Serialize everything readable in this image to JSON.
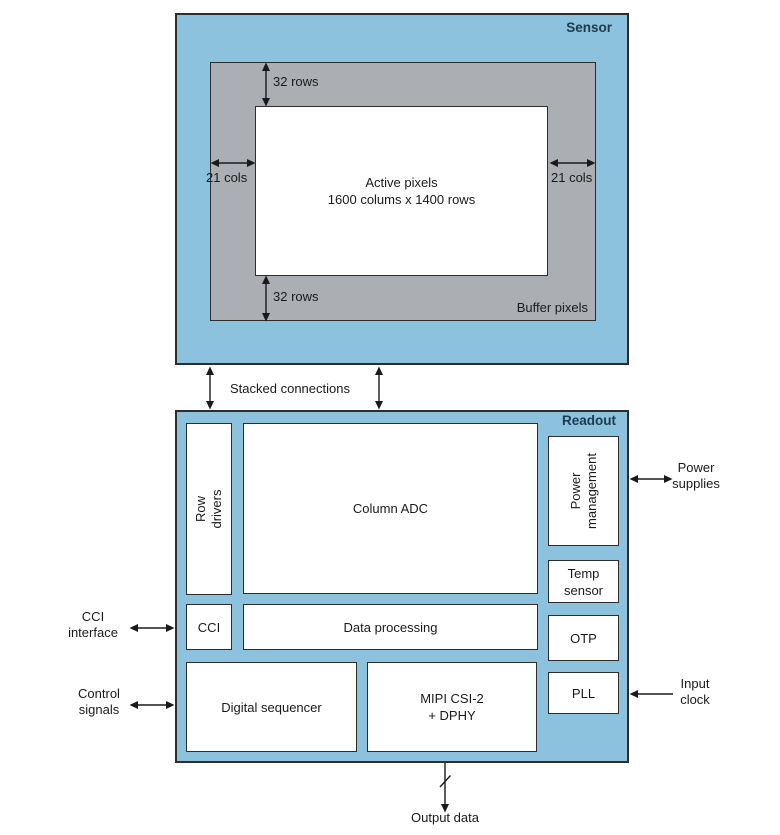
{
  "diagram": {
    "sensor": {
      "title": "Sensor",
      "buffer_label": "Buffer pixels",
      "active_pixels": "Active pixels\n1600 colums x 1400 rows",
      "dim_top_rows": "32 rows",
      "dim_bottom_rows": "32 rows",
      "dim_left_cols": "21 cols",
      "dim_right_cols": "21 cols"
    },
    "interconnect": {
      "label": "Stacked connections"
    },
    "readout": {
      "title": "Readout",
      "row_drivers": "Row drivers",
      "column_adc": "Column ADC",
      "power_management": "Power\nmanagement",
      "temp_sensor": "Temp\nsensor",
      "cci": "CCI",
      "data_processing": "Data processing",
      "otp": "OTP",
      "digital_sequencer": "Digital sequencer",
      "mipi": "MIPI CSI-2\n+ DPHY",
      "pll": "PLL"
    },
    "external": {
      "cci_interface": "CCI\ninterface",
      "control_signals": "Control\nsignals",
      "power_supplies": "Power\nsupplies",
      "input_clock": "Input\nclock",
      "output_data": "Output data"
    },
    "colors": {
      "block_fill": "#8cc2de",
      "buffer_fill": "#abaeb2",
      "box_fill": "#ffffff",
      "border": "#2d2d2d",
      "title_text": "#1c3a4d",
      "text": "#1a1a1a"
    }
  }
}
